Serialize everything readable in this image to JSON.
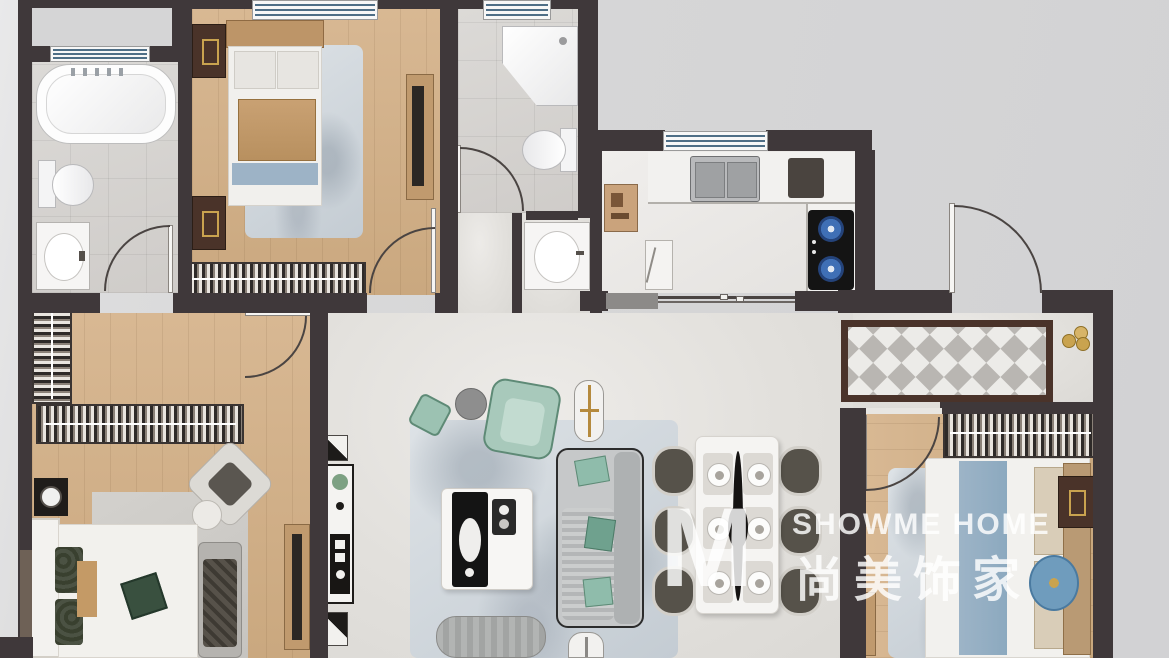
{
  "watermark": {
    "logo": "M",
    "brand_en": "SHOWME HOME",
    "brand_cn": "尚美饰家"
  },
  "palette": {
    "background": "#d6d6d7",
    "wall": "#3f383a",
    "wall_light_brown": "#6e6156",
    "wood_floor": "#d3b28c",
    "hall_tile": "#e3e1de",
    "bath_tile": "#d8d6d3",
    "kitchen_counter": "#f2f1ef",
    "window_stripe": "#4e6e86",
    "teal_furniture": "#9cc2b2",
    "rug_blue_grey": "#c7ced4",
    "checker_grey": "#b9b6b2",
    "checker_border": "#4a332a",
    "hob_black": "#141414",
    "burner_blue": "#3f6fb5",
    "gold_accent": "#c9a34f",
    "watermark_white": "rgba(255,255,255,0.82)"
  }
}
